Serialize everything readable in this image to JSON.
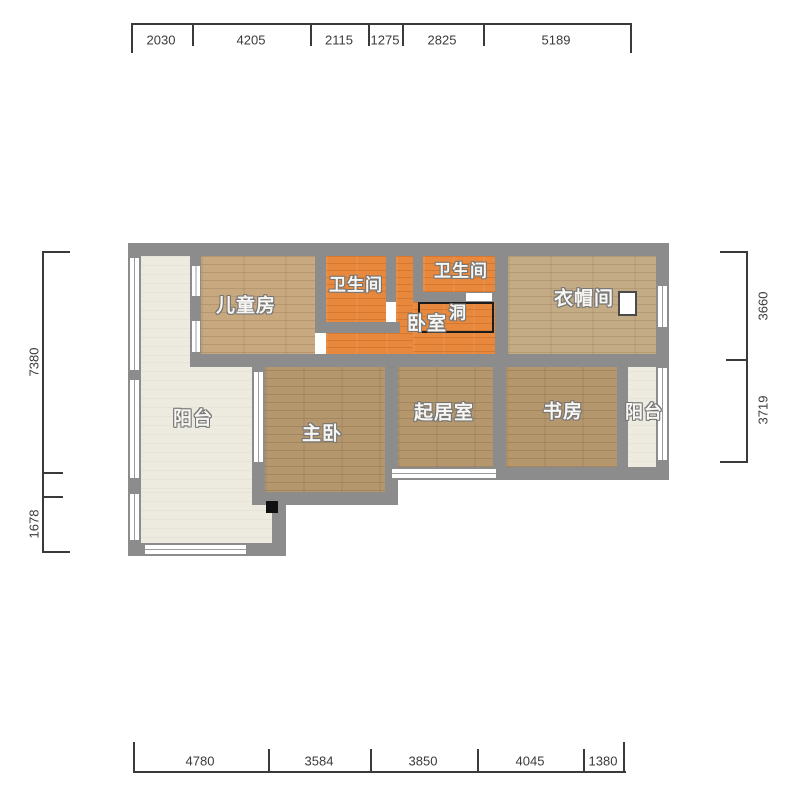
{
  "rooms": {
    "children_room": "儿童房",
    "bathroom_top_left": "卫生间",
    "bathroom_top_right": "卫生间",
    "bedroom": "卧室",
    "opening": "洞",
    "cloakroom": "衣帽间",
    "balcony_left": "阳台",
    "master_bedroom": "主卧",
    "living_room": "起居室",
    "study": "书房",
    "balcony_right": "阳台"
  },
  "dimensions": {
    "top": [
      "2030",
      "4205",
      "2115",
      "1275",
      "2825",
      "5189"
    ],
    "bottom": [
      "4780",
      "3584",
      "3850",
      "4045",
      "1380"
    ],
    "left": [
      "7380",
      "1678"
    ],
    "right": [
      "3660",
      "3719"
    ]
  },
  "colors": {
    "wall": "#8c8c8c",
    "floor_wood_tan": "#c8a87e",
    "floor_wood_brown": "#b5976e",
    "floor_orange": "#e8883c",
    "floor_cream": "#edeadf",
    "opening_outline": "#1c1c1c",
    "dimension_text": "#3a3a3a"
  }
}
